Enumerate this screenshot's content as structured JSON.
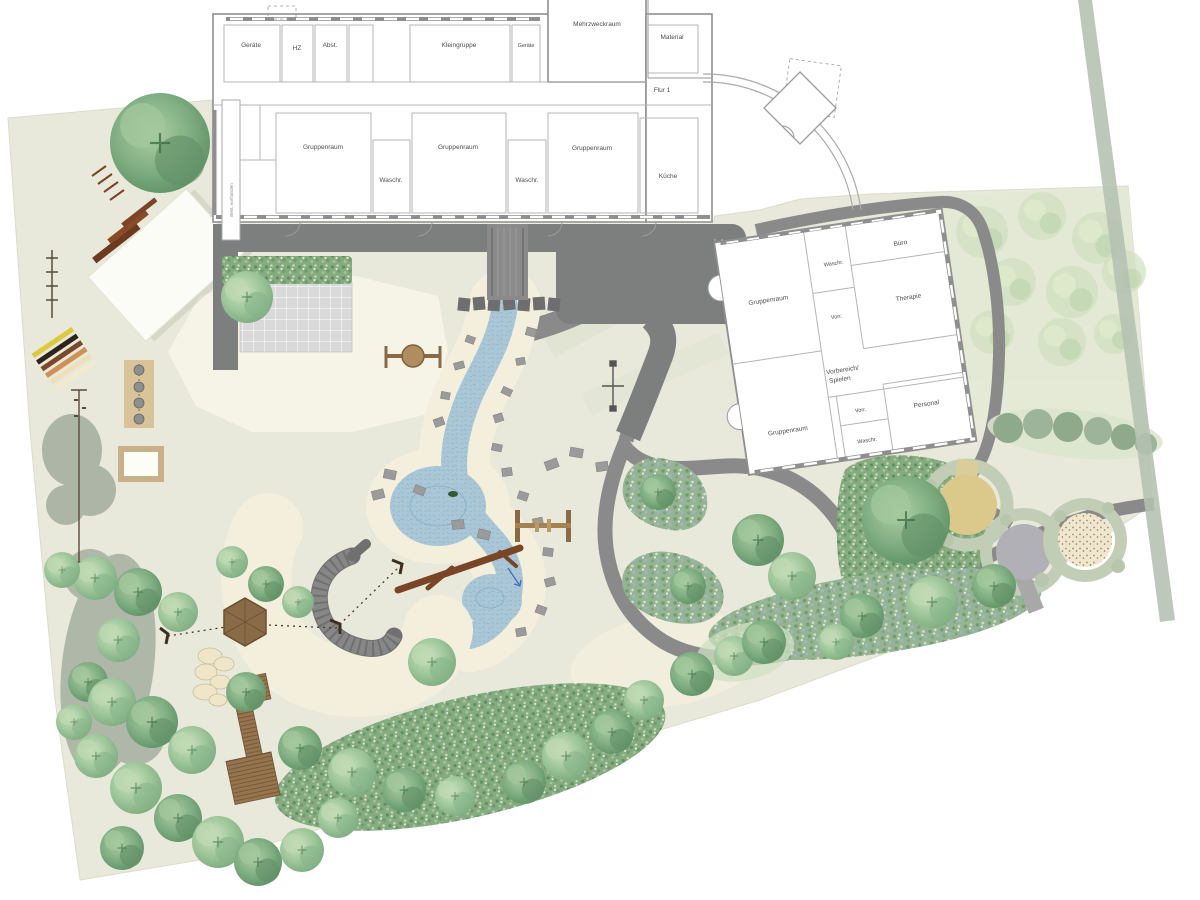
{
  "plan": {
    "type": "landscape-site-plan",
    "description_visible_text_only": true
  },
  "building_main": {
    "rooms": {
      "geraete_nw": "Geräte",
      "hz": "HZ",
      "abstell": "Abst.",
      "kleingruppe": "Kleingruppe",
      "geraete_ne": "Geräte",
      "mehrzweckraum": "Mehrzweckraum",
      "material": "Material",
      "flur": "Flur 1",
      "gruppenraum_1": "Gruppenraum",
      "waschraum_1": "Waschr.",
      "gruppenraum_2": "Gruppenraum",
      "waschraum_2": "Waschr.",
      "gruppenraum_3": "Gruppenraum",
      "kueche": "Küche",
      "bestand_note": "Best. vorhanden"
    }
  },
  "building_annex": {
    "rooms": {
      "gruppenraum_nord": "Gruppenraum",
      "waschraum_nord": "Waschr.",
      "vorraum_nord": "Vorr.",
      "buero": "Büro",
      "therapie": "Therapie",
      "vorbereich_zeile1": "Vorbereich/",
      "vorbereich_zeile2": "Spielen",
      "vorraum_sued": "Vorr.",
      "waschraum_sued": "Waschr.",
      "personal": "Personal",
      "gruppenraum_sued": "Gruppenraum"
    }
  },
  "colors": {
    "ground": "#e9e9db",
    "sand": "#f4efdd",
    "path_gray": "#8a8a8a",
    "terrace_gray": "#7d7e7e",
    "water_blue": "#a9c7d6",
    "tree_green": "#8fba8e",
    "dense_planting": "#86ab7f",
    "gray_green_shrub": "#a9b3a4",
    "wood_brown": "#96744d",
    "log_brown": "#7a4526",
    "tile_gray": "#d9d9d9",
    "hedge_ring": "#c2cdb6",
    "circle_yellow": "#dbc88b",
    "circle_gray": "#b0b0b6",
    "circle_beige": "#eee6cf",
    "boundary_stripe": "#b4c0b2",
    "wall_line": "#8f8f8f"
  }
}
